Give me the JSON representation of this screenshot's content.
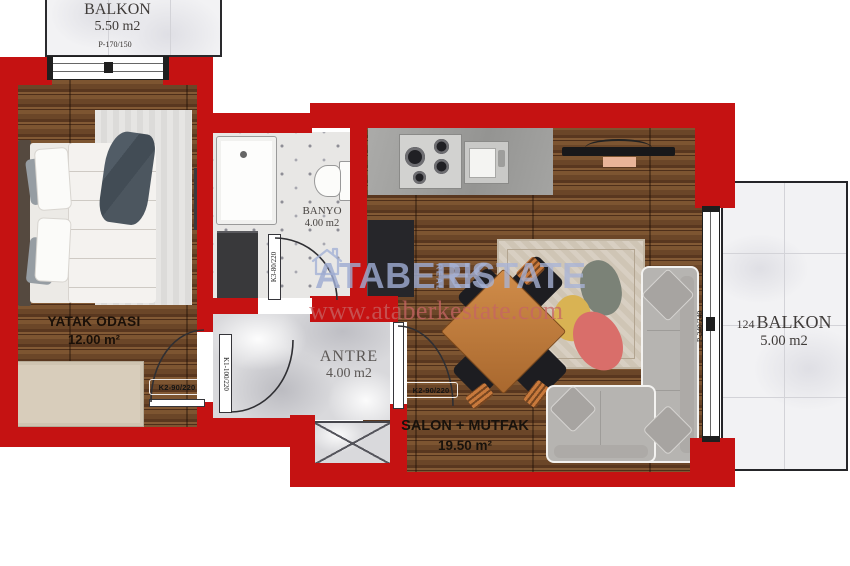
{
  "watermark": {
    "brand_primary": "ATABERK",
    "brand_small": "REAL",
    "brand_secondary": "ESTATE",
    "website": "www.ataberkestate.com"
  },
  "rooms": {
    "balcony_top": {
      "name": "BALKON",
      "area": "5.50 m2"
    },
    "bedroom": {
      "name": "YATAK ODASI",
      "area": "12.00 m²"
    },
    "bathroom": {
      "name": "BANYO",
      "area": "4.00 m2"
    },
    "hall": {
      "name": "ANTRE",
      "area": "4.00 m2"
    },
    "living_kitchen": {
      "name": "SALON + MUTFAK",
      "area": "19.50 m²"
    },
    "balcony_side": {
      "unit_number": "124",
      "name": "BALKON",
      "area": "5.00 m2"
    }
  },
  "openings": {
    "bedroom_window": "P-170/150",
    "balcony_door": "P-240/240",
    "entry_door": "K1-100/220",
    "bedroom_door": "K2-90/220",
    "living_door": "K2-90/220",
    "bathroom_door": "K3-80/220"
  },
  "colors": {
    "wall_red": "#c51212",
    "wood_floor": "#6b4628",
    "marble_floor": "#d9d9dc",
    "watermark_blue": "#9eadd4",
    "watermark_url_red": "#c66464"
  }
}
